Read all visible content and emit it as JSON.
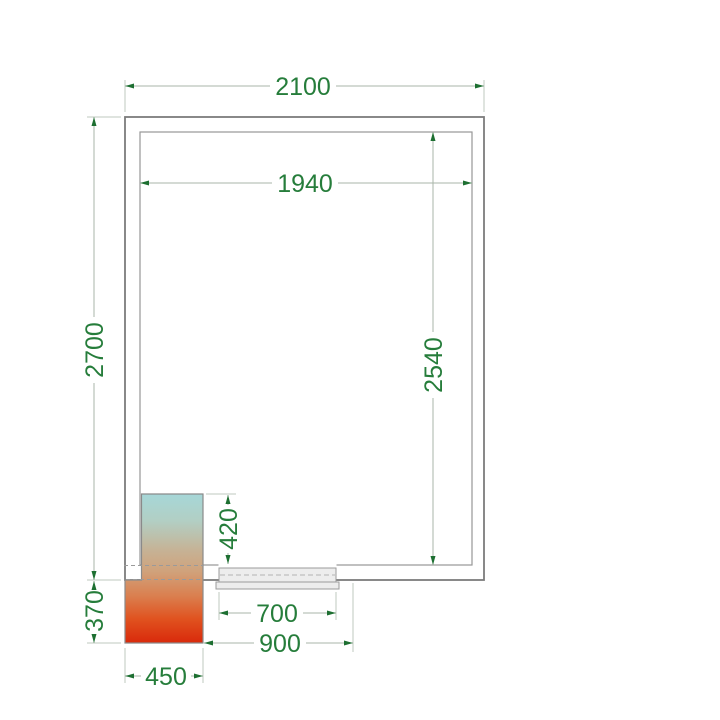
{
  "drawing": {
    "dims": {
      "outer_width": "2100",
      "inner_width": "1940",
      "outer_height": "2700",
      "inner_height": "2540",
      "unit_recess_depth": "420",
      "unit_protrusion": "370",
      "door_opening_width": "700",
      "door_overall_width": "900",
      "unit_width": "450"
    },
    "colors": {
      "dimension_text": "#267d3b",
      "dimension_arrow": "#1d6f31",
      "dimension_line": "#a9b6a9",
      "wall_stroke": "#7c7c7c",
      "inner_wall_stroke": "#979797",
      "door_fill": "#ededed",
      "unit_gradient": [
        "#a6d7d8",
        "#b2cfc4",
        "#c6b295",
        "#d0a27b",
        "#da8050",
        "#e0521f",
        "#d9290b"
      ]
    }
  }
}
